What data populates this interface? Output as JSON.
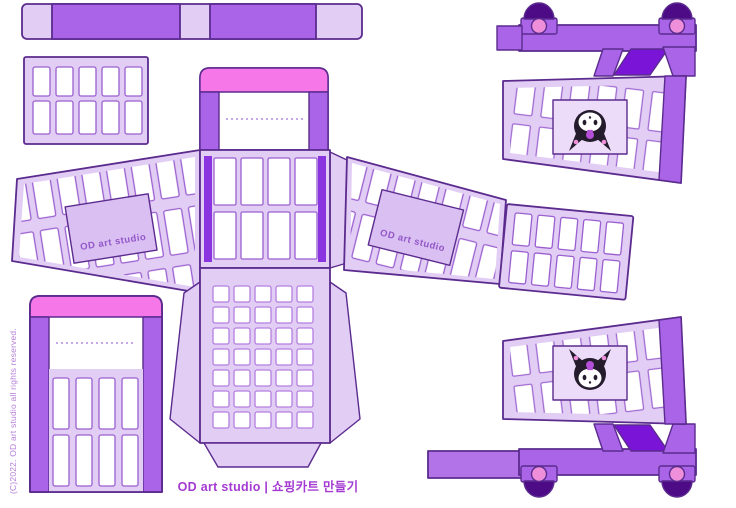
{
  "texts": {
    "footer_credit": "OD art studio | 쇼핑카트 만들기",
    "copyright": "(C)2022. OD art studio all rights reserved.",
    "left_wing_label": "OD art studio",
    "right_wing_label": "OD art studio"
  },
  "icons": {
    "character_badge": "kuromi-face"
  },
  "colors": {
    "background": "#ffffff",
    "panel_light": "#e2cdf5",
    "accent_medium": "#a964e8",
    "accent_dark": "#7a15d8",
    "wheel_dome_dark": "#4d0b86",
    "handle_pink": "#f678e8",
    "wheel_hub_pink": "#ef8fd9",
    "outline": "#5b2b8e",
    "cell_stroke": "#9a5fd0",
    "label_fill": "#d9bff2",
    "footer_text": "#a43ad2",
    "copyright_text": "#b57fd8"
  }
}
